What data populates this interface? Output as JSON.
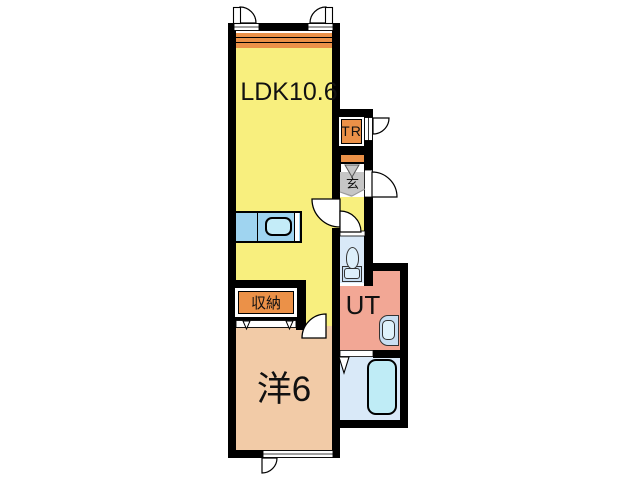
{
  "plan": {
    "type": "apartment-floor-plan",
    "rooms": {
      "ldk": {
        "label": "LDK10.6",
        "color": "#F8EF7E"
      },
      "tr_closet": {
        "label": "TR",
        "color": "#EB9148"
      },
      "genkan": {
        "label": "玄",
        "color": "#C6C6C6"
      },
      "closet": {
        "label": "収納",
        "color": "#EB9148"
      },
      "utility": {
        "label": "UT",
        "color": "#F2A795"
      },
      "western_room": {
        "label": "洋6",
        "color": "#F2CBA7"
      }
    },
    "fixtures": [
      "kitchen-counter",
      "kitchen-sink",
      "toilet",
      "washbasin",
      "bathtub",
      "shoe-cabinet",
      "balcony-strip",
      "closet-doors"
    ],
    "colors": {
      "wall": "#000000",
      "background": "#FFFFFF",
      "water_area": "#D9E9F8",
      "bathtub": "#BFECF6",
      "kitchen_counter": "#9FD4F0",
      "accent_orange": "#EB9148"
    }
  }
}
